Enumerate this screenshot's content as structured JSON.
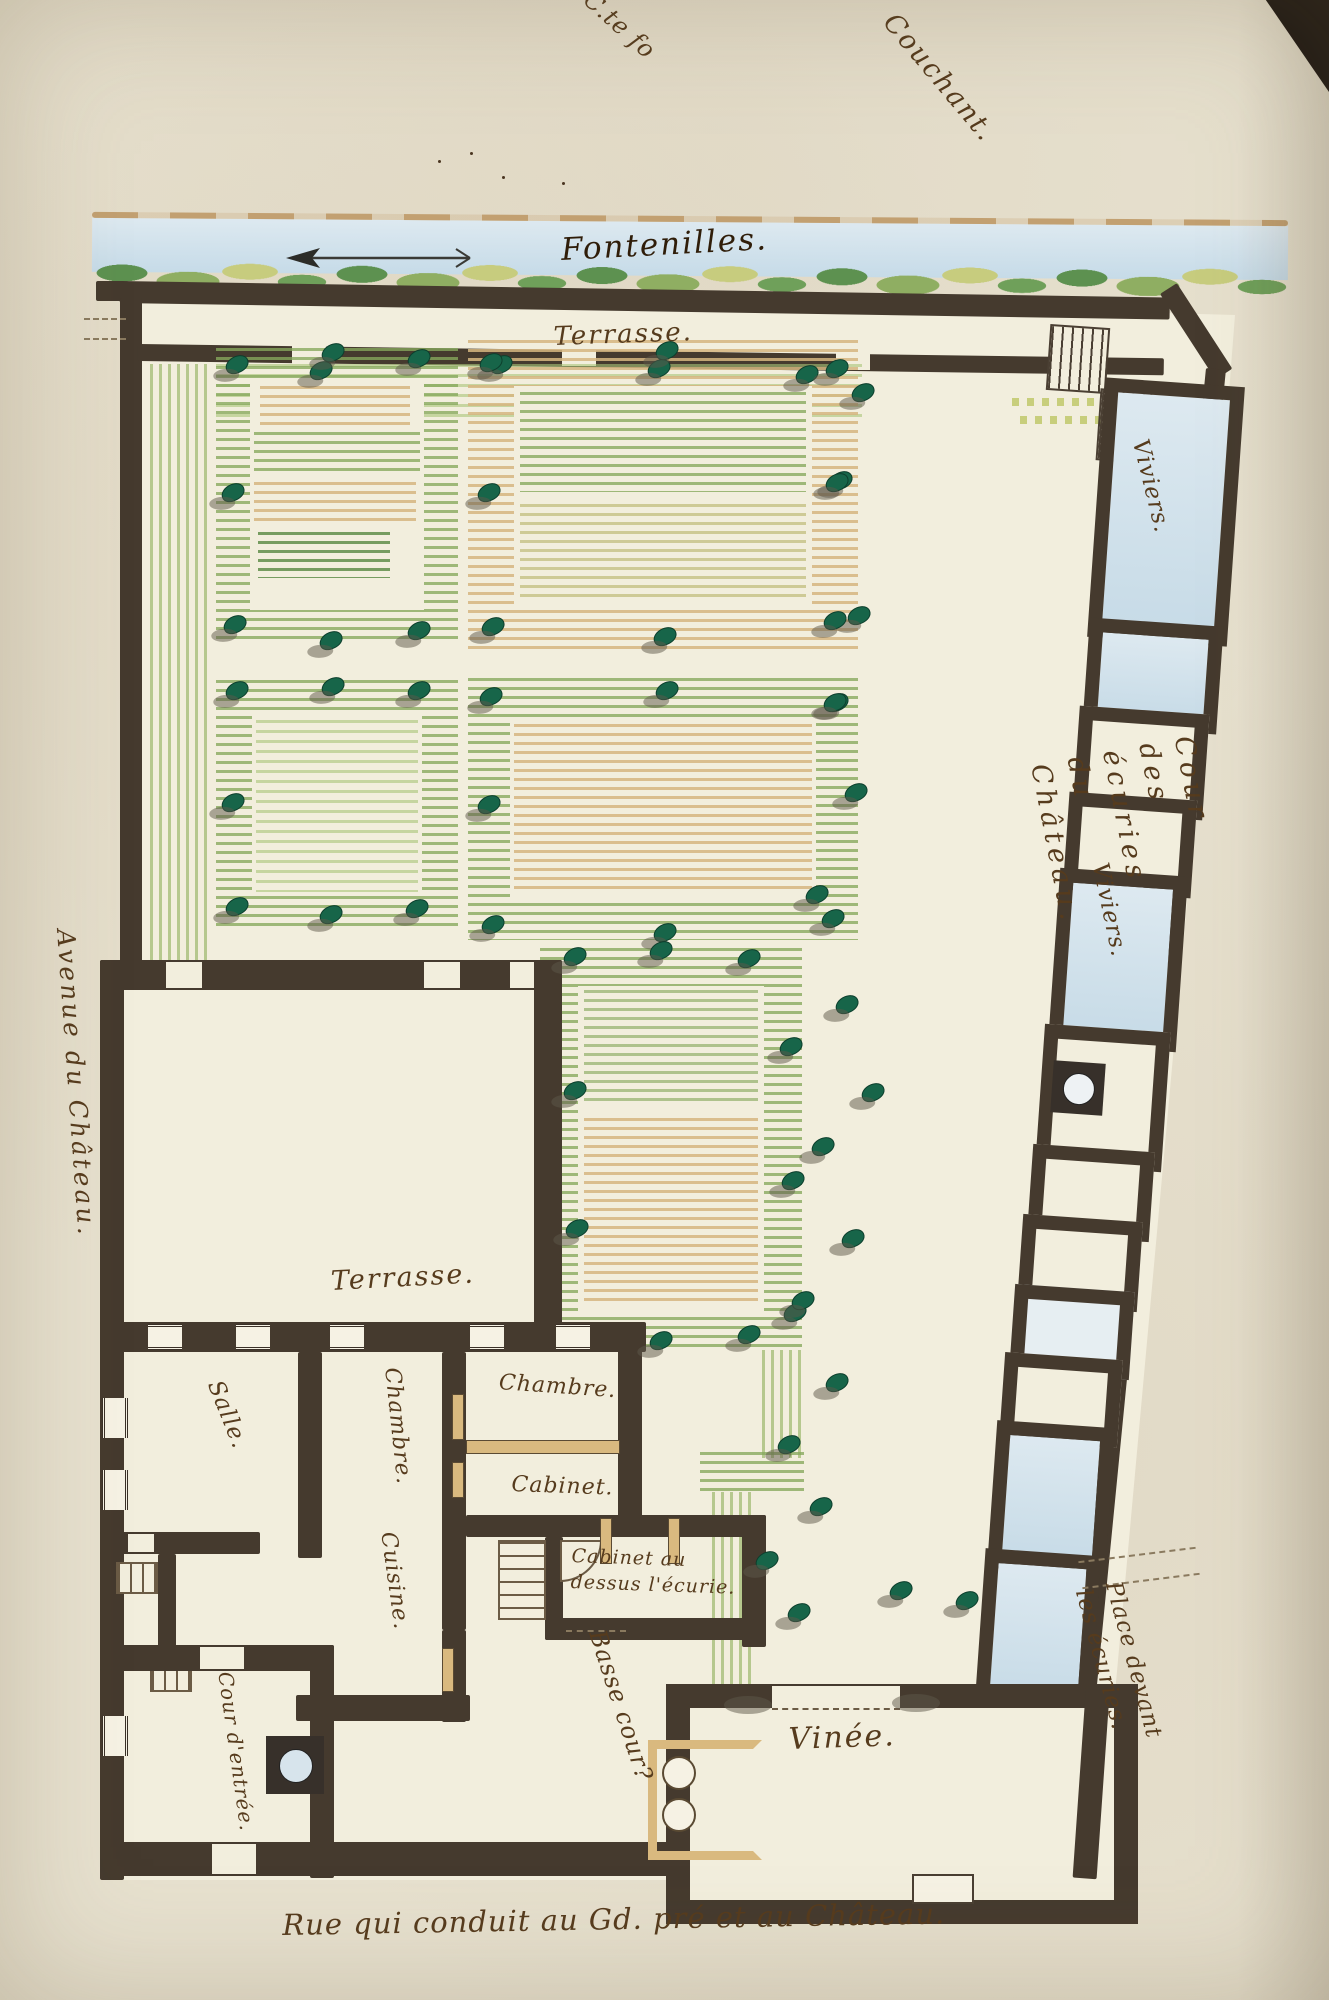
{
  "labels": {
    "corner_note": {
      "text": "C.te fo"
    },
    "couchant": {
      "text": "Couchant."
    },
    "fontenilles": {
      "text": "Fontenilles."
    },
    "terrasse_haut": {
      "text": "Terrasse."
    },
    "viviers_haut": {
      "text": "Viviers."
    },
    "cour_ecuries": {
      "text": "Cour des écuries du Château."
    },
    "viviers_bas": {
      "text": "Viviers."
    },
    "avenue": {
      "text": "Avenue du Château."
    },
    "terrasse_bas": {
      "text": "Terrasse."
    },
    "salle": {
      "text": "Salle."
    },
    "chambre_g": {
      "text": "Chambre."
    },
    "chambre_d": {
      "text": "Chambre."
    },
    "cabinet": {
      "text": "Cabinet."
    },
    "cuisine": {
      "text": "Cuisine."
    },
    "cabinet_ecurie": {
      "text": "Cabinet au\ndessus l'écurie."
    },
    "basse_cour": {
      "text": "Basse cour?"
    },
    "cour_entree": {
      "text": "Cour d'entrée."
    },
    "vinee": {
      "text": "Vinée."
    },
    "place_ecuries": {
      "text": "Place devant les écuries."
    },
    "rue": {
      "text": "Rue qui conduit au Gd. pré et au Château."
    }
  },
  "colors": {
    "paper": "#e7e1cf",
    "plan": "#f2eedd",
    "wall": "#453a2e",
    "ink": "#563b1d",
    "ink-dark": "#2f1d09",
    "water": "#cfdfe9",
    "tan": "#dcc394",
    "wood": "#d9b97f",
    "green": "#a6c17e",
    "tree": "#176549"
  },
  "map_symbols": {
    "compass_arrow": "west-arrow",
    "tree_positions": [
      [
        320,
        370
      ],
      [
        500,
        364
      ],
      [
        658,
        368
      ],
      [
        806,
        374
      ],
      [
        862,
        392
      ],
      [
        840,
        480
      ],
      [
        858,
        615
      ],
      [
        836,
        702
      ],
      [
        855,
        792
      ],
      [
        816,
        894
      ],
      [
        236,
        364
      ],
      [
        332,
        352
      ],
      [
        418,
        358
      ],
      [
        232,
        492
      ],
      [
        234,
        624
      ],
      [
        330,
        640
      ],
      [
        418,
        630
      ],
      [
        490,
        362
      ],
      [
        666,
        350
      ],
      [
        836,
        368
      ],
      [
        488,
        492
      ],
      [
        836,
        482
      ],
      [
        492,
        626
      ],
      [
        664,
        636
      ],
      [
        834,
        620
      ],
      [
        236,
        690
      ],
      [
        332,
        686
      ],
      [
        418,
        690
      ],
      [
        232,
        802
      ],
      [
        236,
        906
      ],
      [
        330,
        914
      ],
      [
        416,
        908
      ],
      [
        490,
        696
      ],
      [
        666,
        690
      ],
      [
        834,
        702
      ],
      [
        488,
        804
      ],
      [
        492,
        924
      ],
      [
        664,
        932
      ],
      [
        832,
        918
      ],
      [
        574,
        956
      ],
      [
        660,
        950
      ],
      [
        748,
        958
      ],
      [
        790,
        1046
      ],
      [
        574,
        1090
      ],
      [
        576,
        1228
      ],
      [
        660,
        1340
      ],
      [
        748,
        1334
      ],
      [
        792,
        1180
      ],
      [
        794,
        1312
      ],
      [
        846,
        1004
      ],
      [
        872,
        1092
      ],
      [
        822,
        1146
      ],
      [
        852,
        1238
      ],
      [
        802,
        1300
      ],
      [
        836,
        1382
      ],
      [
        788,
        1444
      ],
      [
        820,
        1506
      ],
      [
        766,
        1560
      ],
      [
        798,
        1612
      ],
      [
        900,
        1590
      ],
      [
        966,
        1600
      ]
    ]
  }
}
